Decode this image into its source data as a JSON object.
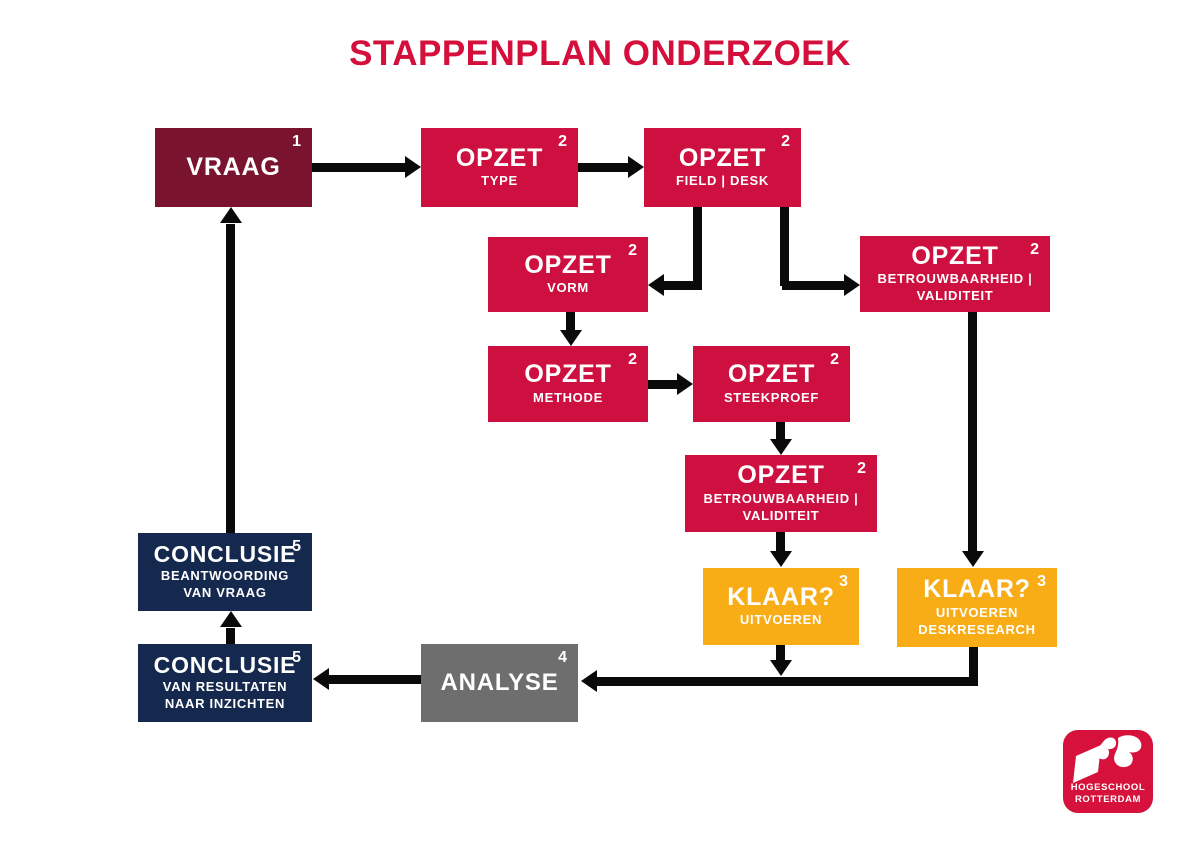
{
  "title": "STAPPENPLAN ONDERZOEK",
  "nodes": {
    "vraag": {
      "label": "VRAAG",
      "num": "1"
    },
    "opzet_type": {
      "label": "OPZET",
      "num": "2",
      "sub1": "TYPE"
    },
    "opzet_field_desk": {
      "label": "OPZET",
      "num": "2",
      "sub1": "FIELD | DESK"
    },
    "opzet_vorm": {
      "label": "OPZET",
      "num": "2",
      "sub1": "VORM"
    },
    "opzet_betrouw_right": {
      "label": "OPZET",
      "num": "2",
      "sub1": "BETROUWBAARHEID |",
      "sub2": "VALIDITEIT"
    },
    "opzet_methode": {
      "label": "OPZET",
      "num": "2",
      "sub1": "METHODE"
    },
    "opzet_steekproef": {
      "label": "OPZET",
      "num": "2",
      "sub1": "STEEKPROEF"
    },
    "opzet_betrouw_mid": {
      "label": "OPZET",
      "num": "2",
      "sub1": "BETROUWBAARHEID |",
      "sub2": "VALIDITEIT"
    },
    "klaar_uitvoeren": {
      "label": "KLAAR?",
      "num": "3",
      "sub1": "UITVOEREN"
    },
    "klaar_deskresearch": {
      "label": "KLAAR?",
      "num": "3",
      "sub1": "UITVOEREN",
      "sub2": "DESKRESEARCH"
    },
    "analyse": {
      "label": "ANALYSE",
      "num": "4"
    },
    "conclusie_top": {
      "label": "CONCLUSIE",
      "num": "5",
      "sub1": "BEANTWOORDING",
      "sub2": "VAN VRAAG"
    },
    "conclusie_bottom": {
      "label": "CONCLUSIE",
      "num": "5",
      "sub1": "VAN RESULTATEN",
      "sub2": "NAAR INZICHTEN"
    }
  },
  "edges": [
    {
      "from": "vraag",
      "to": "opzet-type"
    },
    {
      "from": "opzet-type",
      "to": "opzet-field-desk"
    },
    {
      "from": "opzet-field-desk",
      "to": "opzet-vorm"
    },
    {
      "from": "opzet-field-desk",
      "to": "opzet-betrouwbaarheid-validiteit-right"
    },
    {
      "from": "opzet-vorm",
      "to": "opzet-methode"
    },
    {
      "from": "opzet-methode",
      "to": "opzet-steekproef"
    },
    {
      "from": "opzet-steekproef",
      "to": "opzet-betrouwbaarheid-validiteit-mid"
    },
    {
      "from": "opzet-betrouwbaarheid-validiteit-mid",
      "to": "klaar-uitvoeren"
    },
    {
      "from": "opzet-betrouwbaarheid-validiteit-right",
      "to": "klaar-uitvoeren-deskresearch"
    },
    {
      "from": "klaar-uitvoeren",
      "to": "analyse"
    },
    {
      "from": "klaar-uitvoeren-deskresearch",
      "to": "analyse"
    },
    {
      "from": "analyse",
      "to": "conclusie-van-resultaten"
    },
    {
      "from": "conclusie-van-resultaten",
      "to": "conclusie-beantwoording"
    },
    {
      "from": "conclusie-beantwoording",
      "to": "vraag"
    }
  ],
  "logo": {
    "line1": "HOGESCHOOL",
    "line2": "ROTTERDAM"
  },
  "colors": {
    "title_red": "#D40F3C",
    "crimson": "#CD103F",
    "maroon": "#7A142E",
    "navy": "#15284D",
    "yellow": "#F8AC16",
    "gray": "#6E6E6E",
    "arrow_black": "#0A0A0A",
    "logo_red": "#D6123C",
    "text_white": "#FFFFFF"
  }
}
